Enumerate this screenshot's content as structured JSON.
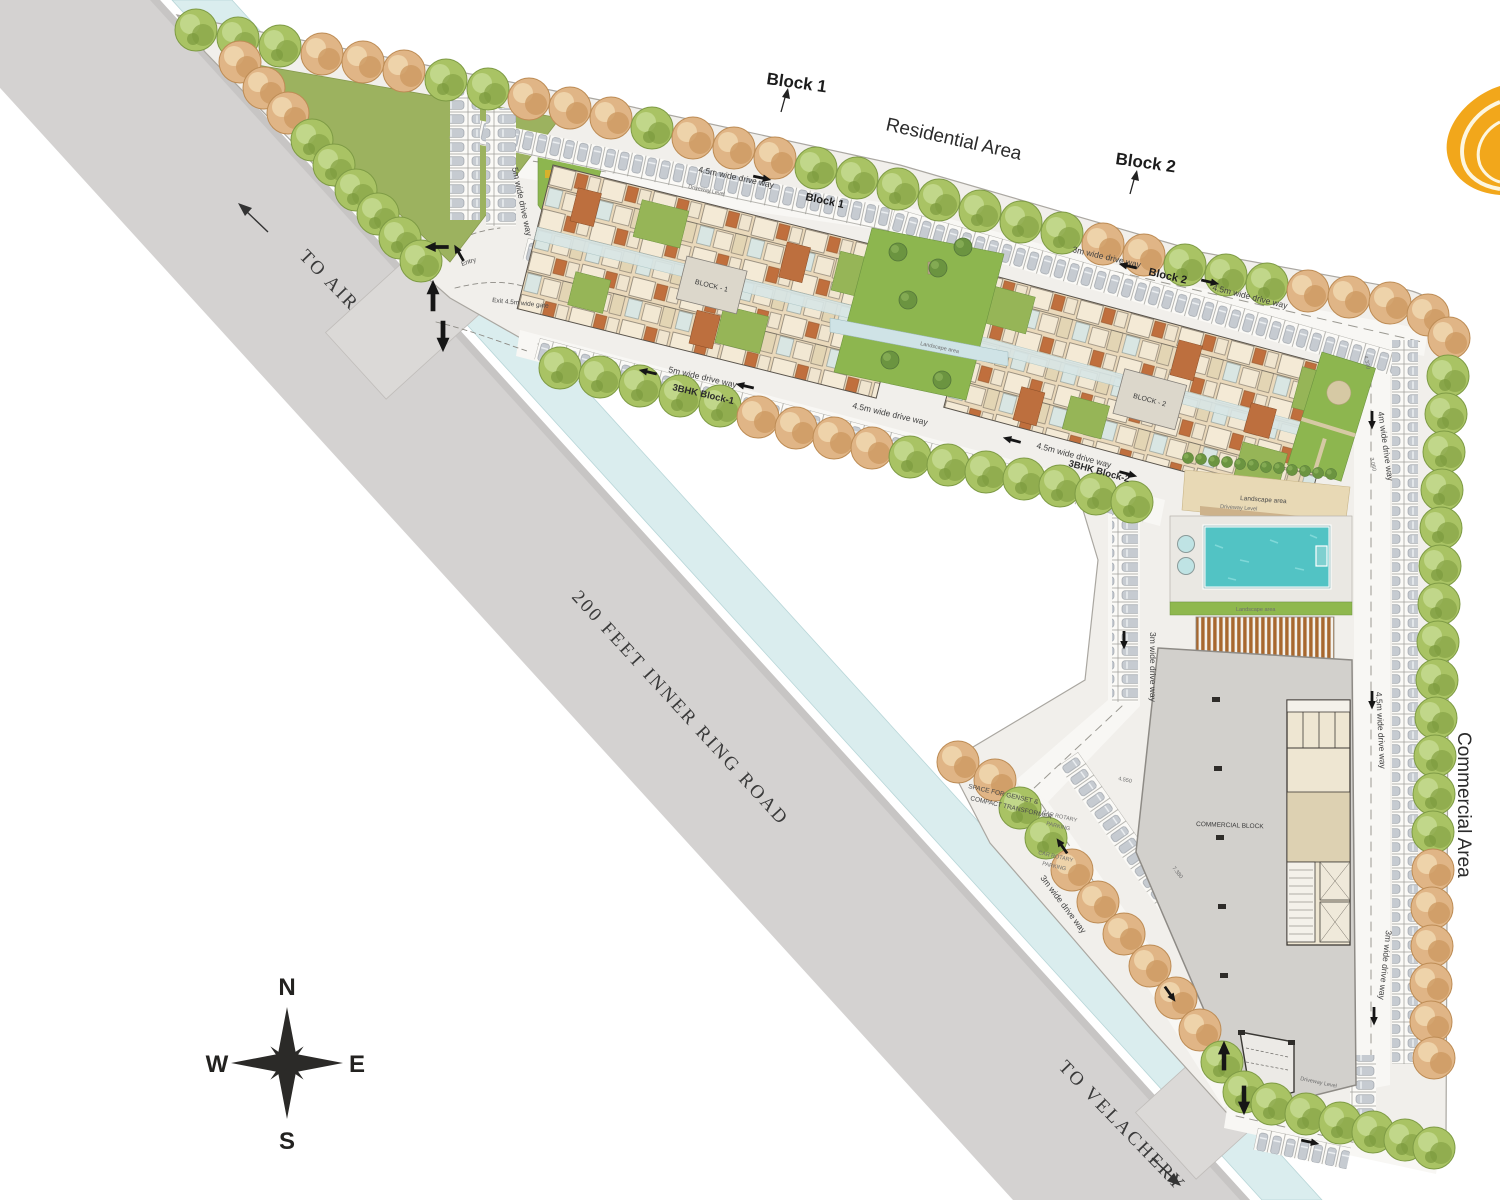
{
  "title": "Residential and commercial site master plan",
  "labels": {
    "to_airport": "TO AIRPORT",
    "ring_road": "200 FEET INNER RING ROAD",
    "to_velachery": "TO VELACHERY",
    "residential_area": "Residential Area",
    "commercial_area": "Commercial Area",
    "landscape": "Landscape area",
    "bhk1": "3BHK Block-1",
    "bhk2": "3BHK Block-2",
    "bldg1": "BLOCK - 1",
    "bldg2": "BLOCK - 2",
    "commercial_block": "COMMERCIAL BLOCK"
  },
  "callouts": {
    "block1": "Block 1",
    "block2": "Block 2"
  },
  "dw": {
    "w45": "4.5m wide drive way",
    "w3": "3m wide drive way",
    "w4": "4m wide drive way",
    "w5": "5m wide drive way"
  },
  "gates": {
    "entry": "Entry",
    "exit": "Exit 4.5m wide gate"
  },
  "notes": {
    "genset1": "SPACE FOR GENSET &",
    "genset2": "COMPACT TRANSFORMER",
    "rotary1": "CAR ROTARY",
    "rotary2": "PARKING",
    "level": "Driveway Level"
  },
  "dims": {
    "d4330": "4.330",
    "d3060": "3.060",
    "d4550": "4.550",
    "d7380": "7.380"
  },
  "compass": {
    "n": "N",
    "e": "E",
    "s": "S",
    "w": "W"
  },
  "colors": {
    "road": "#d4d2d1",
    "water_channel": "#daedee",
    "site_ground": "#f1efeb",
    "tree_green": "#a9c364",
    "tree_orange": "#e0b586",
    "lawn": "#9cb25f",
    "building_beige": "#ead9bb",
    "building_brown": "#c06f3d",
    "pool": "#52c3c4",
    "pergola": "#a8682f",
    "commercial_gray": "#d2d0cc",
    "logo_orange": "#F2A71B"
  }
}
